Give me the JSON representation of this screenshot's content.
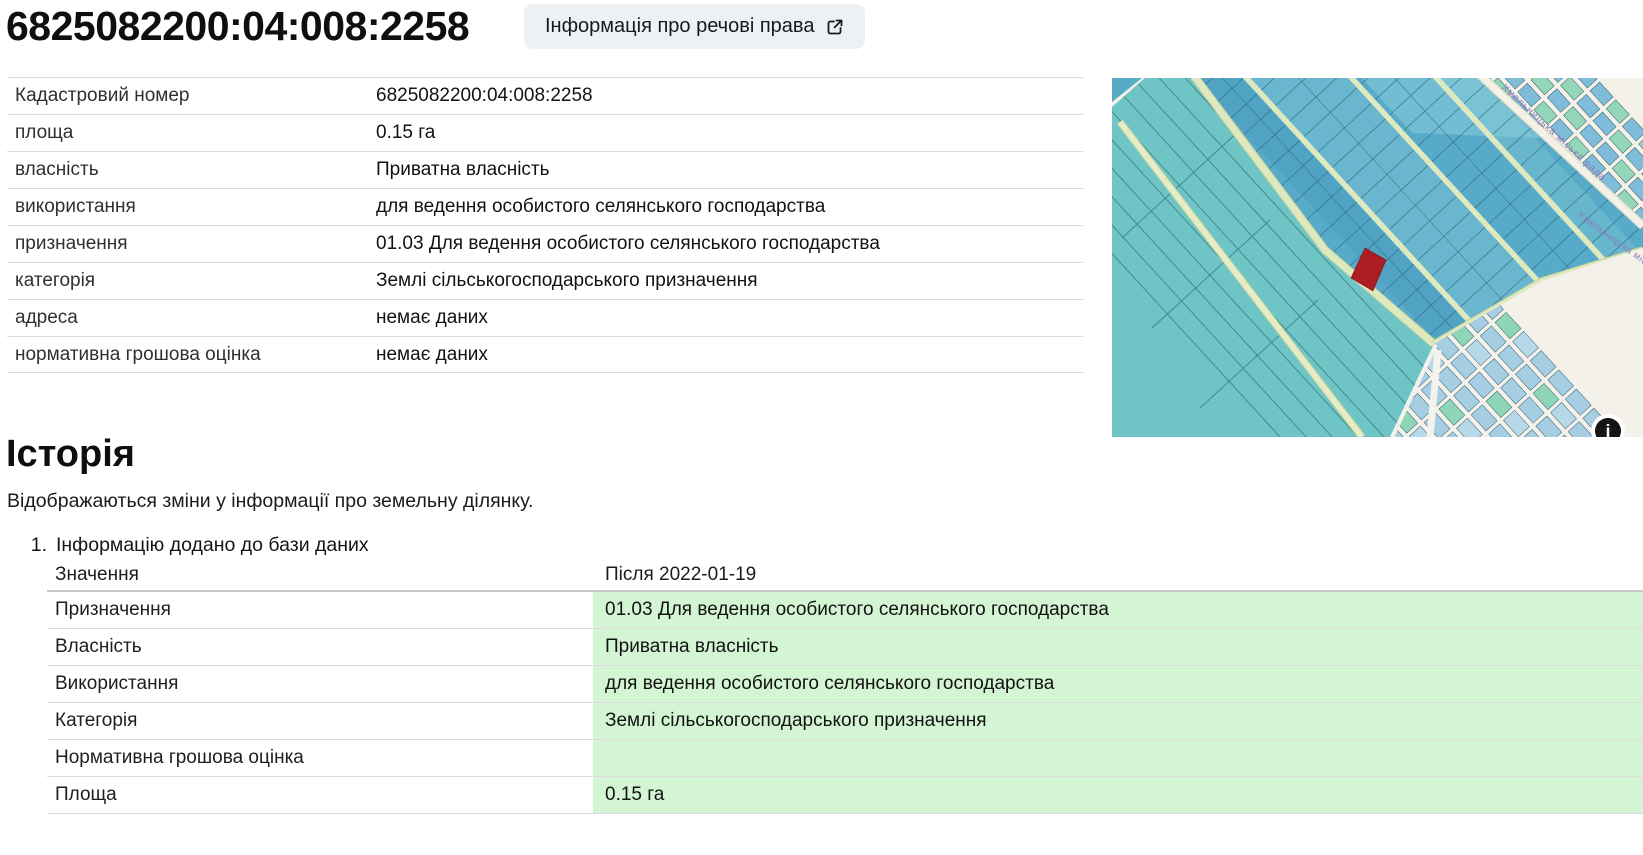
{
  "header": {
    "cadastral_number": "6825082200:04:008:2258",
    "rights_button_label": "Інформація про речові права"
  },
  "properties": {
    "rows": [
      {
        "label": "Кадастровий номер",
        "value": "6825082200:04:008:2258"
      },
      {
        "label": "площа",
        "value": "0.15 га"
      },
      {
        "label": "власність",
        "value": "Приватна власність"
      },
      {
        "label": "використання",
        "value": "для ведення особистого селянського господарства"
      },
      {
        "label": "призначення",
        "value": "01.03 Для ведення особистого селянського господарства"
      },
      {
        "label": "категорія",
        "value": "Землі сільськогосподарського призначення"
      },
      {
        "label": "адреса",
        "value": "немає даних"
      },
      {
        "label": "нормативна грошова оцінка",
        "value": "немає даних"
      }
    ]
  },
  "map": {
    "road_label": "Хмельницька міська рада",
    "info_glyph": "i",
    "highlight_color": "#ad1d23",
    "field_teal": "#6fc5c5",
    "parcel_blue": "#58abc8",
    "road_green": "#dfe9c0",
    "urban_bg": "#f0ede4"
  },
  "history": {
    "title": "Історія",
    "subtitle": "Відображаються зміни у інформації про земельну ділянку.",
    "entries": [
      {
        "index": "1.",
        "title": "Інформацію додано до бази даних",
        "columns": {
          "name": "Значення",
          "after": "Після 2022-01-19"
        },
        "rows": [
          {
            "label": "Призначення",
            "value": "01.03 Для ведення особистого селянського господарства"
          },
          {
            "label": "Власність",
            "value": "Приватна власність"
          },
          {
            "label": "Використання",
            "value": "для ведення особистого селянського господарства"
          },
          {
            "label": "Категорія",
            "value": "Землі сільськогосподарського призначення"
          },
          {
            "label": "Нормативна грошова оцінка",
            "value": ""
          },
          {
            "label": "Площа",
            "value": "0.15 га"
          }
        ]
      }
    ]
  }
}
